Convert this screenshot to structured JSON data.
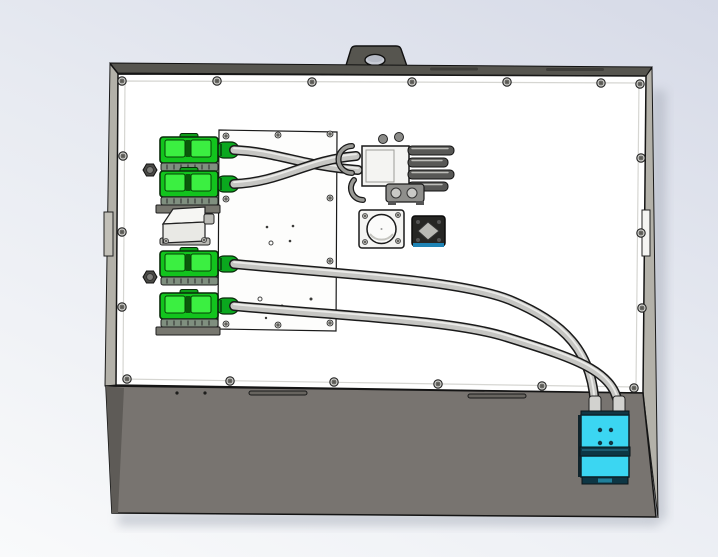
{
  "scene": {
    "kind": "3d-cad-render",
    "subject": "electrical-enclosure-assembly-front-view"
  },
  "colors": {
    "bgtop": "#d6dae7",
    "bgmid": "#e7eaf1",
    "bgbottom": "#f9fafb",
    "outline": "#1a1a1a",
    "panel": "#ffffff",
    "panelframe": "#d6d6d2",
    "raildark": "#56554f",
    "railinset": "#3e3d39",
    "sidewall": "#b3b1a9",
    "base": "#787470",
    "baseshade": "#5e5b57",
    "plate": "#fdfdfc",
    "green": "#12c41d",
    "greenlight": "#3bef41",
    "greenboot": "#0aa81e",
    "greendark": "#0a5a0a",
    "cable": "#c6c6c3",
    "cableline": "#1a1a1a",
    "cablehl": "#ebebe9",
    "metallight": "#f4f4f2",
    "metalmid": "#9a9a96",
    "metaldark": "#585856",
    "cyan": "#3bd6f2",
    "cyandark": "#0d3644",
    "blueaccent": "#1f83b4",
    "screwbody": "#c9c9c5",
    "screwcore": "#8f8f8b",
    "shadow": "#aab0bc",
    "holeface": "#c9cdd6"
  },
  "parts": [
    {
      "id": "mounting-tab",
      "quantity": 1,
      "color": "raildark"
    },
    {
      "id": "enclosure-front-panel",
      "quantity": 1,
      "color": "panel",
      "screw_count": 20
    },
    {
      "id": "inner-mounting-plate",
      "quantity": 1,
      "color": "plate",
      "screw_count": 10
    },
    {
      "id": "green-power-connector",
      "quantity": 4,
      "color": "green"
    },
    {
      "id": "hex-nut",
      "quantity": 2
    },
    {
      "id": "angled-hood-connector",
      "quantity": 1,
      "color": "metallight"
    },
    {
      "id": "inline-connector-assembly",
      "quantity": 1,
      "color": "metalmid"
    },
    {
      "id": "circular-panel-connector",
      "quantity": 1,
      "color": "metallight"
    },
    {
      "id": "square-panel-connector",
      "quantity": 1,
      "color": "blueaccent"
    },
    {
      "id": "power-cable",
      "quantity": 4,
      "color": "cable"
    },
    {
      "id": "cyan-output-connector",
      "quantity": 1,
      "color": "cyan"
    },
    {
      "id": "enclosure-base",
      "quantity": 1,
      "color": "base"
    }
  ]
}
